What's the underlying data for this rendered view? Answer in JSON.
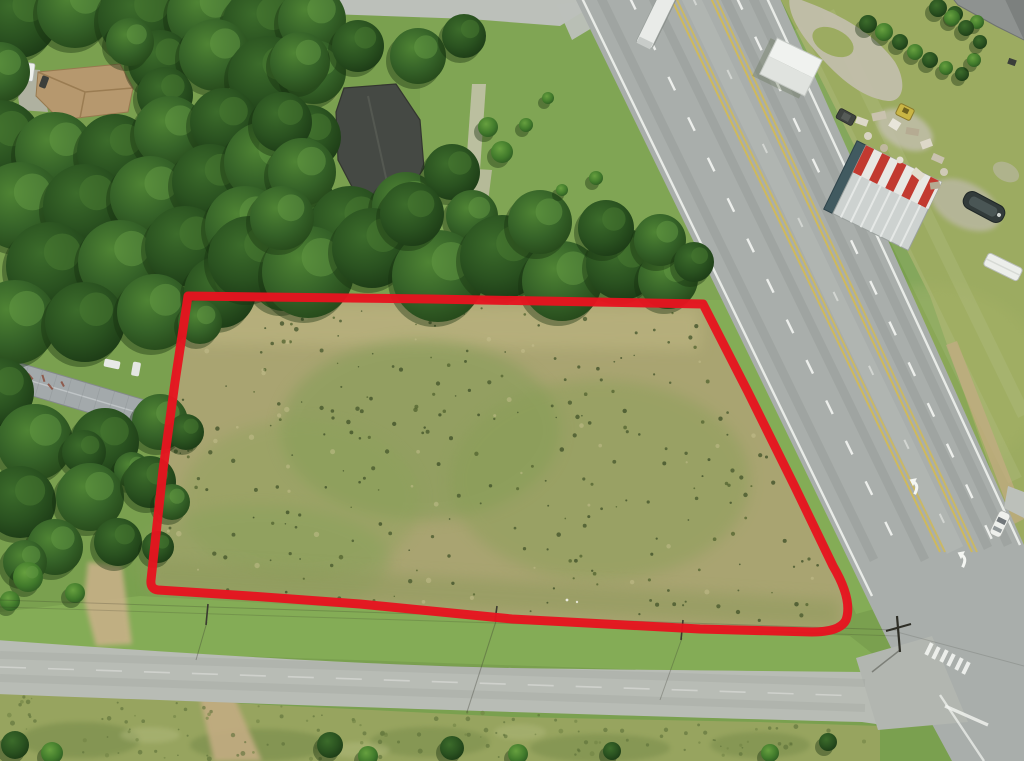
{
  "meta": {
    "kind": "aerial-drone-photograph",
    "description": "Aerial real-estate photo of a vacant grass parcel outlined with a thick red boundary, bordered by a diagonal multi-lane highway on the east, a small paved road on the south, a minor road at top, dense tree canopy on the north and west, and rural homes/outbuildings around it. No text is rendered in the image."
  },
  "colors": {
    "boundary_red": "#e6141f",
    "asphalt_highway": "#a9aeab",
    "asphalt_side_road": "#b8bcb5",
    "asphalt_top_road": "#bcc0ba",
    "base_grass": "#7aa04f",
    "east_lawn": "#9cab61",
    "field_tan": "#a9a471",
    "verge_green": "#84ac56",
    "scrub_green": "#97a45f",
    "tree_dark": "#27491d",
    "dirt_tan": "#c5ab83",
    "gravel": "#c3bfae",
    "lane_yellow": "#d6bc4e",
    "marking_white": "#f4f6f2",
    "shed_white": "#f0f2ef",
    "roof_dark_house": "#454944",
    "roof_tan_house": "#b6986e",
    "roof_left_house": "#a3a9ab",
    "roof_striped_red": "#c23a30",
    "wall_teal": "#415a60",
    "truck_white": "#e9ebe8",
    "car_white": "#eef0ec",
    "car_blue": "#2e4a78"
  },
  "annotation": {
    "parcel_boundary": {
      "shape": "quadrilateral with rounded south-east corner",
      "stroke_width_px": 9,
      "corners_px": [
        [
          188,
          296
        ],
        [
          703,
          304
        ],
        [
          846,
          598
        ],
        [
          152,
          589
        ]
      ]
    }
  },
  "scene": {
    "roads": [
      {
        "name": "highway",
        "orientation": "diagonal from top-center to bottom-right",
        "lanes": "two each direction plus center turn lane",
        "markings": [
          "white edge lines",
          "white lane dashes",
          "yellow turn-lane lines",
          "two left-turn arrows",
          "crosswalk at intersection"
        ]
      },
      {
        "name": "side-road",
        "orientation": "horizontal across bottom",
        "markings": [
          "faint white center line"
        ]
      },
      {
        "name": "top-road",
        "orientation": "along top edge"
      }
    ],
    "vehicles": [
      {
        "name": "semi-trailer-truck",
        "approx_px": [
          656,
          20
        ]
      },
      {
        "name": "white-car-on-highway",
        "approx_px": [
          1000,
          524
        ]
      },
      {
        "name": "white-pickup-top-left",
        "approx_px": [
          29,
          72
        ]
      },
      {
        "name": "blue-car-under-trees",
        "approx_px": [
          101,
          471
        ]
      },
      {
        "name": "dark-car-by-gravel",
        "approx_px": [
          846,
          117
        ]
      }
    ],
    "structures": [
      {
        "name": "tan-roof-house",
        "approx_px": [
          85,
          92
        ]
      },
      {
        "name": "dark-roof-house",
        "approx_px": [
          380,
          145
        ]
      },
      {
        "name": "left-mobile-home",
        "approx_px": [
          82,
          396
        ]
      },
      {
        "name": "white-shed",
        "approx_px": [
          791,
          67
        ]
      },
      {
        "name": "striped-roof-building",
        "approx_px": [
          888,
          196
        ]
      },
      {
        "name": "corner-house-roof",
        "approx_px": [
          1000,
          15
        ]
      },
      {
        "name": "boat-trailer",
        "approx_px": [
          984,
          207
        ]
      },
      {
        "name": "white-rv",
        "approx_px": [
          1003,
          267
        ]
      }
    ],
    "utilities": [
      {
        "name": "power-line",
        "path": "along north side of side-road"
      },
      {
        "name": "utility-pole-at-intersection",
        "approx_px": [
          897,
          630
        ]
      }
    ]
  }
}
